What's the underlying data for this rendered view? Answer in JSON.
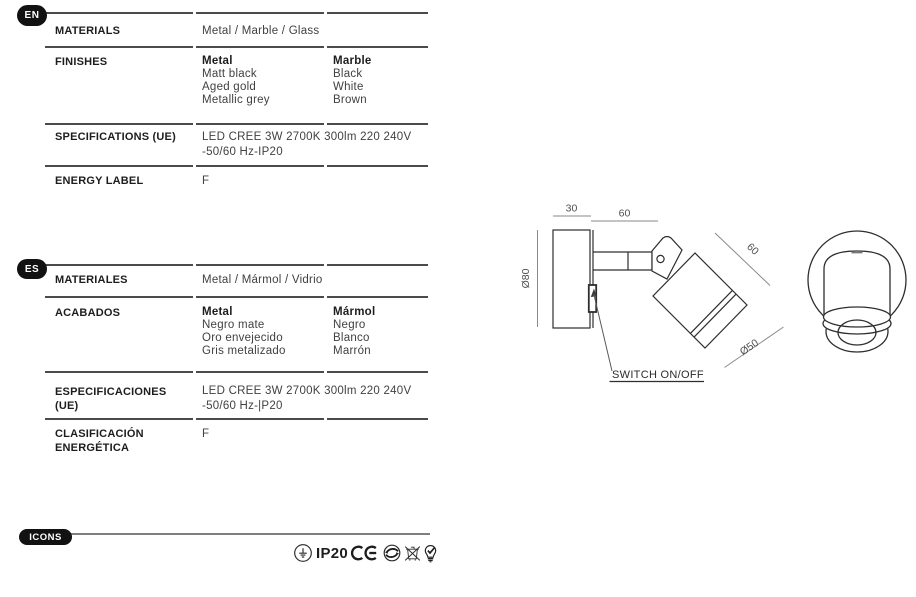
{
  "sections": {
    "en": {
      "badge": "EN",
      "materials": {
        "label": "MATERIALS",
        "value": "Metal / Marble / Glass"
      },
      "finishes": {
        "label": "FINISHES",
        "metal": {
          "header": "Metal",
          "items": [
            "Matt black",
            "Aged gold",
            "Metallic grey"
          ]
        },
        "marble": {
          "header": "Marble",
          "items": [
            "Black",
            "White",
            "Brown"
          ]
        }
      },
      "specifications": {
        "label": "SPECIFICATIONS (UE)",
        "line1": "LED CREE 3W 2700K 300lm 220 240V",
        "line2": "-50/60 Hz-IP20"
      },
      "energy": {
        "label": "ENERGY LABEL",
        "value": "F"
      }
    },
    "es": {
      "badge": "ES",
      "materials": {
        "label": "MATERIALES",
        "value": "Metal / Mármol / Vidrio"
      },
      "finishes": {
        "label": "ACABADOS",
        "metal": {
          "header": "Metal",
          "items": [
            "Negro mate",
            "Oro envejecido",
            "Gris metalizado"
          ]
        },
        "marble": {
          "header": "Mármol",
          "items": [
            "Negro",
            "Blanco",
            "Marrón"
          ]
        }
      },
      "specifications": {
        "label_line1": "ESPECIFICACIONES",
        "label_line2": "(UE)",
        "line1": "LED CREE 3W 2700K 300lm 220 240V",
        "line2": "-50/60 Hz-|P20"
      },
      "energy": {
        "label_line1": "CLASIFICACIÓN",
        "label_line2": "ENERGÉTICA",
        "value": "F"
      }
    },
    "icons": {
      "badge": "ICONS",
      "ip_rating": "IP20",
      "glyphs": [
        "class1-earth",
        "ce-mark",
        "green-dot-recycling",
        "weee-crossed-bin",
        "bulb-check"
      ]
    }
  },
  "drawing": {
    "dim_base_depth": "30",
    "dim_arm_length": "60",
    "dim_base_diameter": "Ø80",
    "dim_head_length": "60",
    "dim_head_diameter": "Ø50",
    "switch_label": "SWITCH ON/OFF"
  },
  "colors": {
    "ink": "#262223",
    "value_text": "#414141",
    "rule": "#4b4b4b",
    "badge_bg": "#121212"
  }
}
